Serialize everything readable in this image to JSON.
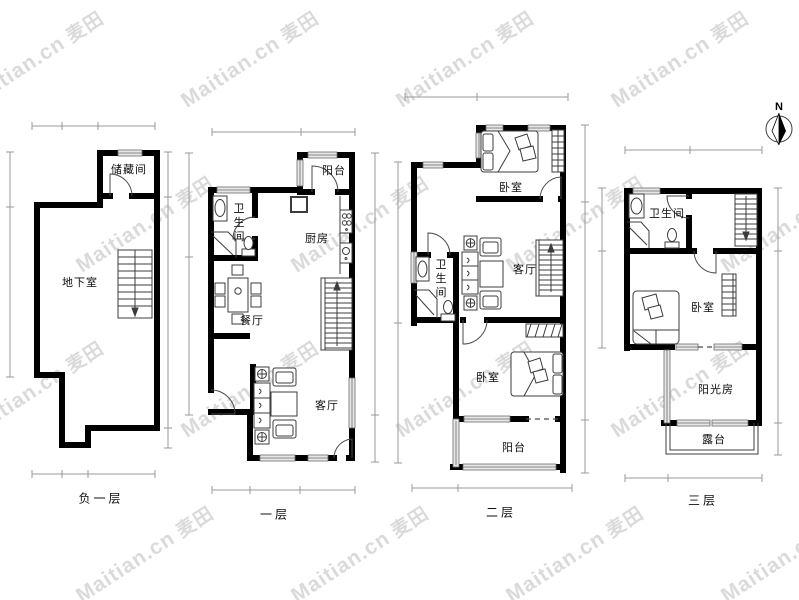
{
  "watermark": {
    "brand": "Maitian.cn",
    "logo": "麦田"
  },
  "compass": {
    "north_label": "N"
  },
  "floors": [
    {
      "name": "负一层",
      "rooms": [
        {
          "label": "储藏间"
        },
        {
          "label": "地下室"
        }
      ]
    },
    {
      "name": "一层",
      "rooms": [
        {
          "label": "阳台"
        },
        {
          "label": "卫生间"
        },
        {
          "label": "厨房"
        },
        {
          "label": "餐厅"
        },
        {
          "label": "客厅"
        }
      ]
    },
    {
      "name": "二层",
      "rooms": [
        {
          "label": "卧室"
        },
        {
          "label": "卫生间"
        },
        {
          "label": "客厅"
        },
        {
          "label": "卧室"
        },
        {
          "label": "阳台"
        }
      ]
    },
    {
      "name": "三层",
      "rooms": [
        {
          "label": "卫生间"
        },
        {
          "label": "卧室"
        },
        {
          "label": "阳光房"
        },
        {
          "label": "露台"
        }
      ]
    }
  ]
}
